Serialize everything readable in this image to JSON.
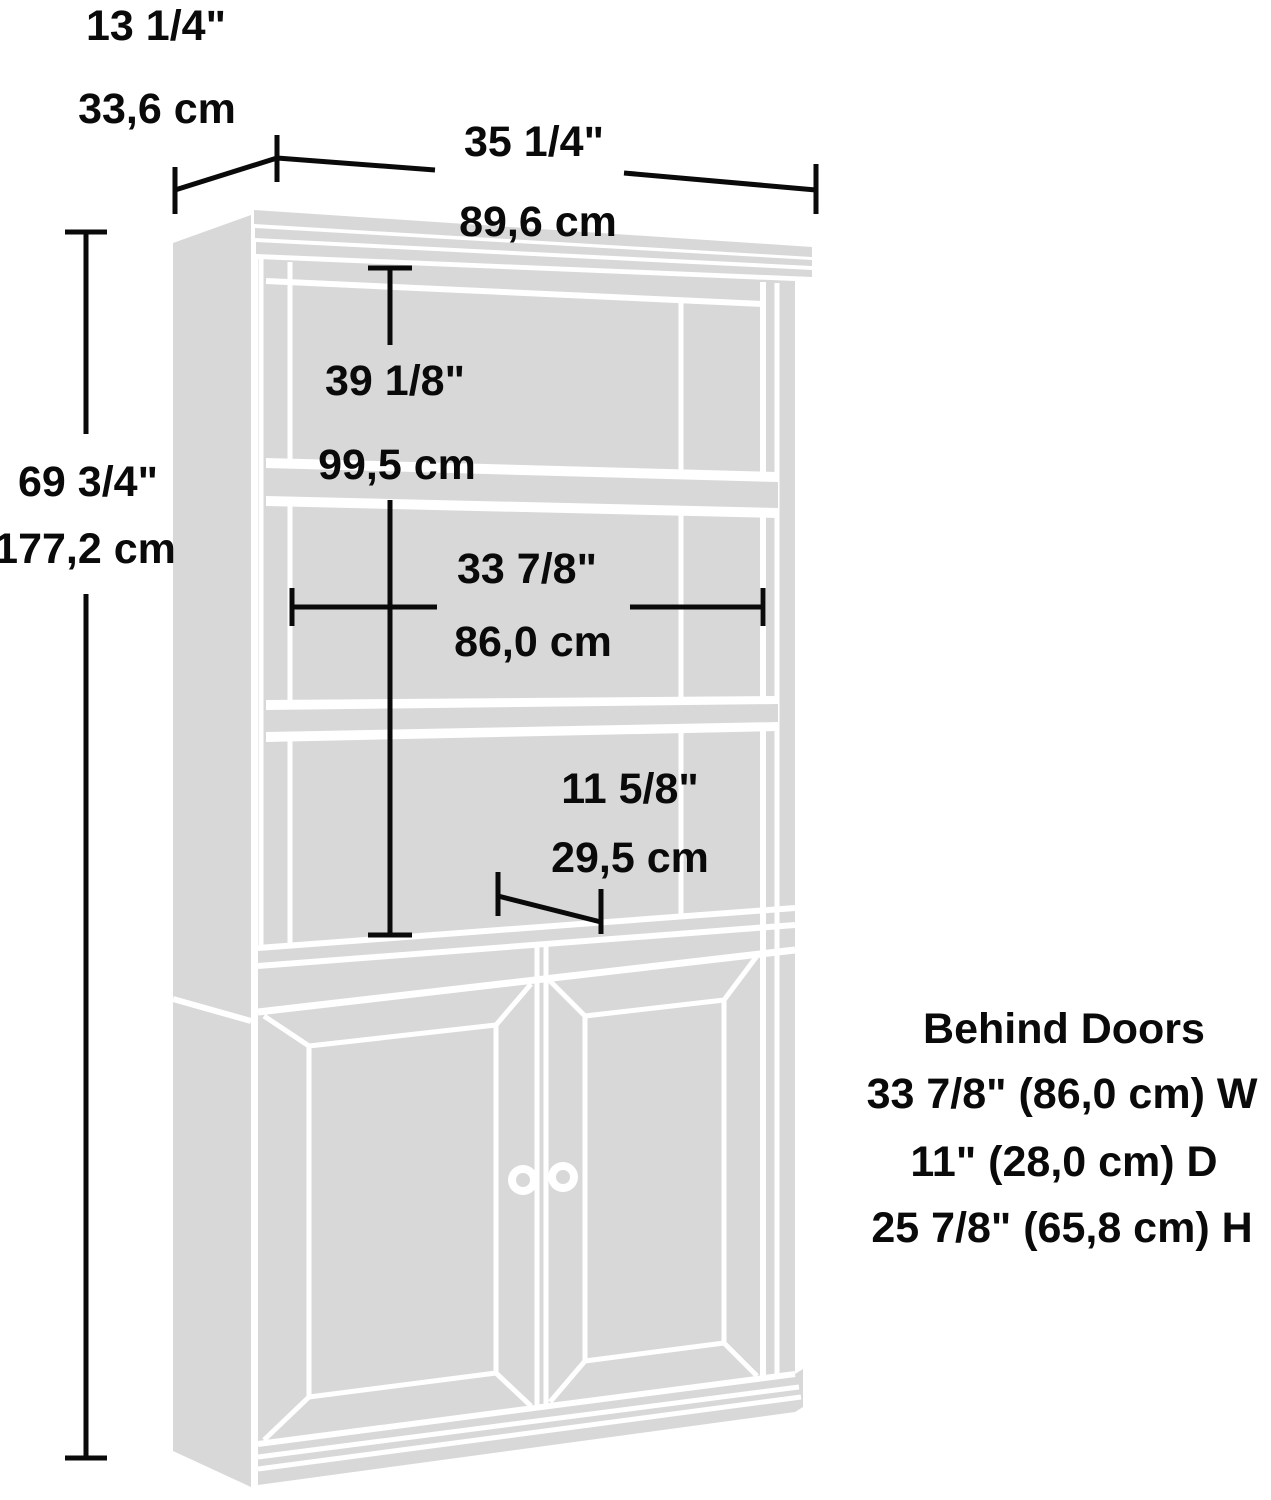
{
  "diagram": {
    "title": "bookcase-with-doors-dimension-diagram",
    "colors": {
      "background": "#ffffff",
      "furniture_fill": "#d8d8d8",
      "gap_lines": "#ffffff",
      "dimension_lines": "#0a0a0a",
      "text": "#0a0a0a"
    },
    "dimensions": {
      "depth_top": {
        "inches": "13 1/4\"",
        "cm": "33,6 cm"
      },
      "width_top": {
        "inches": "35 1/4\"",
        "cm": "89,6 cm"
      },
      "height_left": {
        "inches": "69 3/4\"",
        "cm": "177,2 cm"
      },
      "hutch_height": {
        "inches": "39 1/8\"",
        "cm": "99,5 cm"
      },
      "interior_width": {
        "inches": "33 7/8\"",
        "cm": "86,0 cm"
      },
      "shelf_depth": {
        "inches": "11 5/8\"",
        "cm": "29,5 cm"
      }
    },
    "behind_doors": {
      "title": "Behind Doors",
      "width_line": "33 7/8\" (86,0 cm) W",
      "depth_line": "11\" (28,0 cm) D",
      "height_line": "25 7/8\" (65,8 cm) H"
    }
  }
}
